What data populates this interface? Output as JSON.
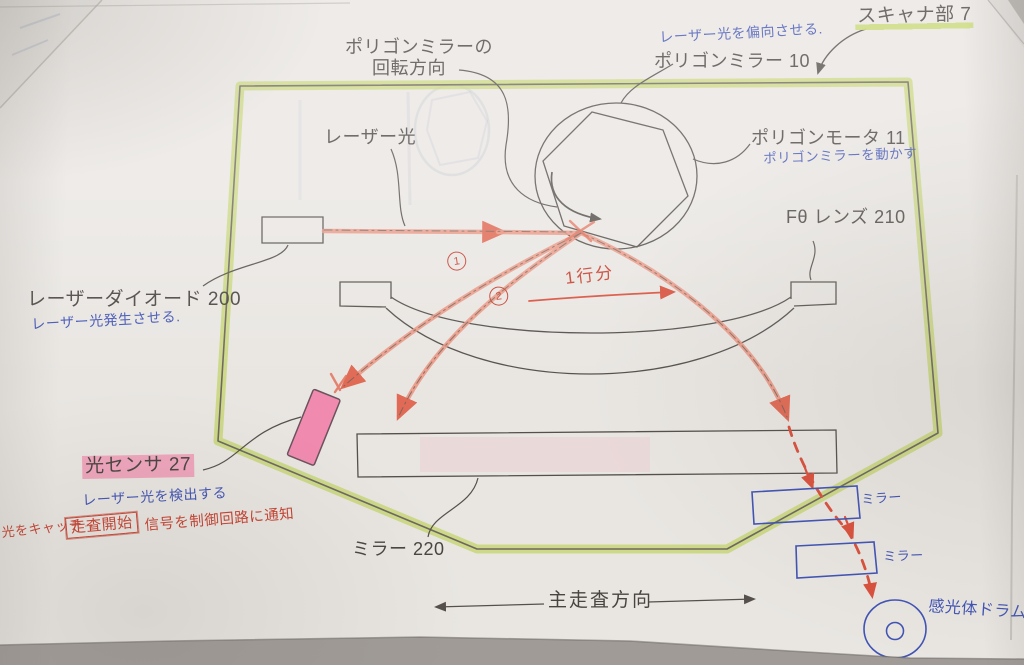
{
  "colors": {
    "highlight_green": "#c3d46a",
    "beam_salmon": "#ea9480",
    "red_pen": "#c6402f",
    "blue_pen": "#4053b4",
    "pink_highlight": "#f470a0",
    "ink": "#55504b"
  },
  "labels": {
    "scanner_unit": "スキャナ部 7",
    "polygon_mirror": "ポリゴンミラー 10",
    "rotation_line1": "ポリゴンミラーの",
    "rotation_line2": "回転方向",
    "laser_light": "レーザー光",
    "polygon_motor": "ポリゴンモータ 11",
    "ftheta_lens": "Fθ レンズ 210",
    "laser_diode": "レーザーダイオード 200",
    "light_sensor": "光センサ 27",
    "mirror_220": "ミラー 220",
    "main_scan_direction": "主走査方向"
  },
  "handwritten": {
    "deflect_note": "レーザー光を偏向させる.",
    "move_mirror_note": "ポリゴンミラーを動かす",
    "generate_note": "レーザー光発生させる.",
    "detect_note": "レーザー光を検出する",
    "catch_note": "光をキャッチ→",
    "scan_start": "走査開始",
    "notify_note": "信号を制御回路に通知",
    "one_line": "1行分",
    "beam1_num": "1",
    "beam2_num": "2",
    "mirror_hand_upper": "ミラー",
    "mirror_hand_lower": "ミラー",
    "drum": "感光体ドラム"
  }
}
